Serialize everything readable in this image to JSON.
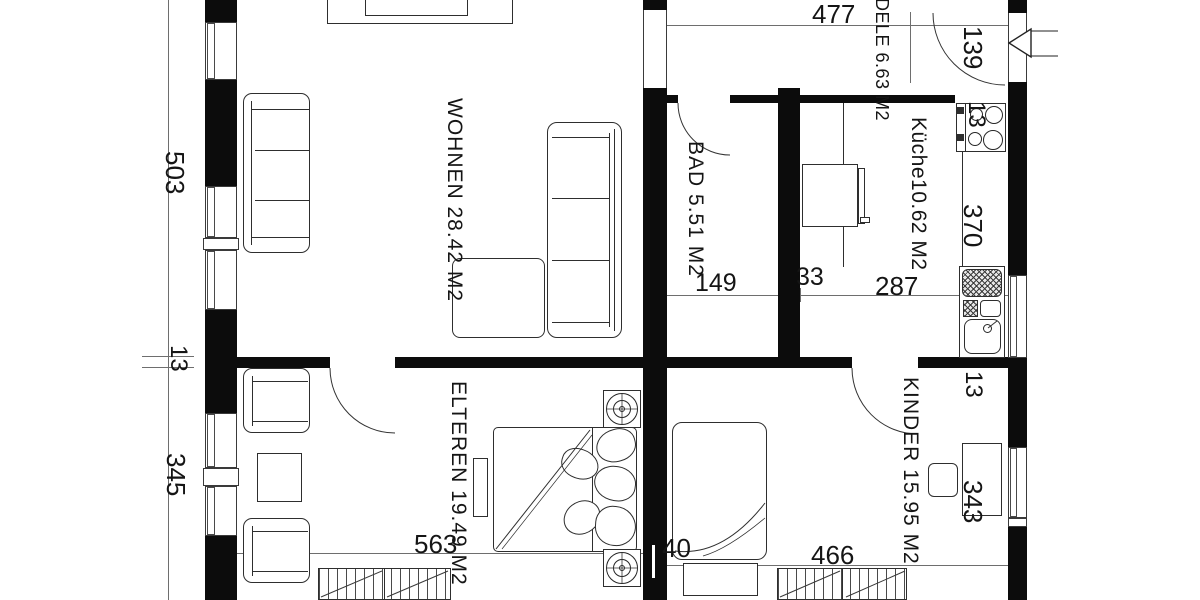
{
  "drawing_type": "apartment floor plan",
  "rooms": {
    "wohnen": "WOHNEN  28.42 M2",
    "bad": "BAD 5.51 M2",
    "kueche": "Küche10.62 M2",
    "diele": "DELE 6.63 M2",
    "elteren": "ELTEREN 19.49 M2",
    "kinder": "KINDER 15.95 M2"
  },
  "dims": {
    "d477": "477",
    "d503": "503",
    "d13_left": "13",
    "d345": "345",
    "d139": "139",
    "d13_stove": "13",
    "d370": "370",
    "d149": "149",
    "d33": "33",
    "d287": "287",
    "d13_kinder": "13",
    "d343": "343",
    "d563": "563",
    "d40": "40",
    "d466": "466"
  },
  "colors": {
    "wall": "#0c0c0c",
    "line": "#2e2e2e",
    "background": "#ffffff"
  }
}
